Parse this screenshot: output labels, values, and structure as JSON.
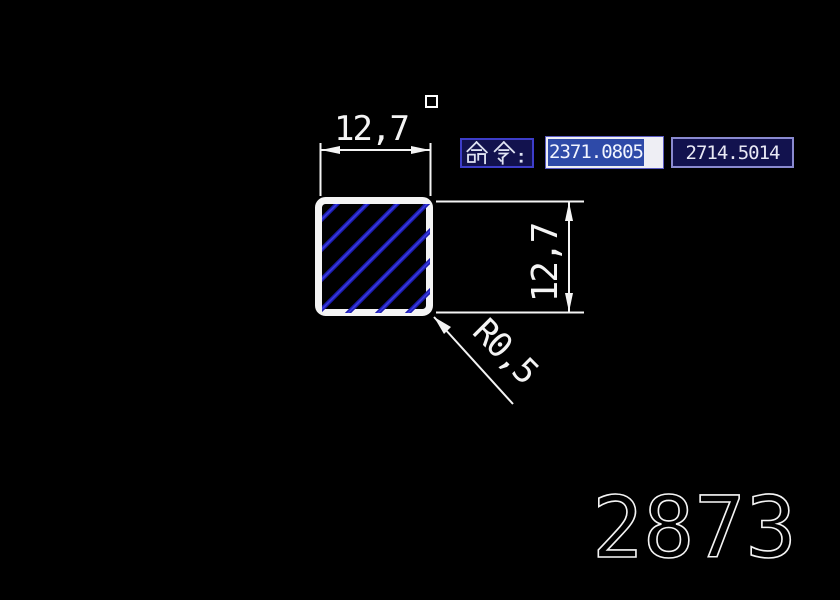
{
  "canvas": {
    "background": "#000000",
    "line_color": "#f4f4f4"
  },
  "drawing": {
    "shape": "rounded-square-with-diagonal-hatch",
    "hatch": {
      "angle_deg": 45,
      "color": "#1c1cb0",
      "highlight_color": "#3c3ce0"
    },
    "dimensions": {
      "top": {
        "label": "12,7"
      },
      "right": {
        "label": "12,7"
      },
      "radius": {
        "label": "R0,5"
      }
    },
    "sheet_number": "2873"
  },
  "command_bar": {
    "label": "命令:",
    "coordinate_x": {
      "value": "2371.0805",
      "selected": true
    },
    "coordinate_y": {
      "value": "2714.5014",
      "selected": false
    },
    "colors": {
      "panel_bg": "#12124e",
      "border_blue": "#3d3dc9",
      "border_light": "#8a8ad0",
      "selection_bg": "#2e4aa8",
      "field_bg": "#eeeef4",
      "text": "#e8e8f4"
    }
  }
}
